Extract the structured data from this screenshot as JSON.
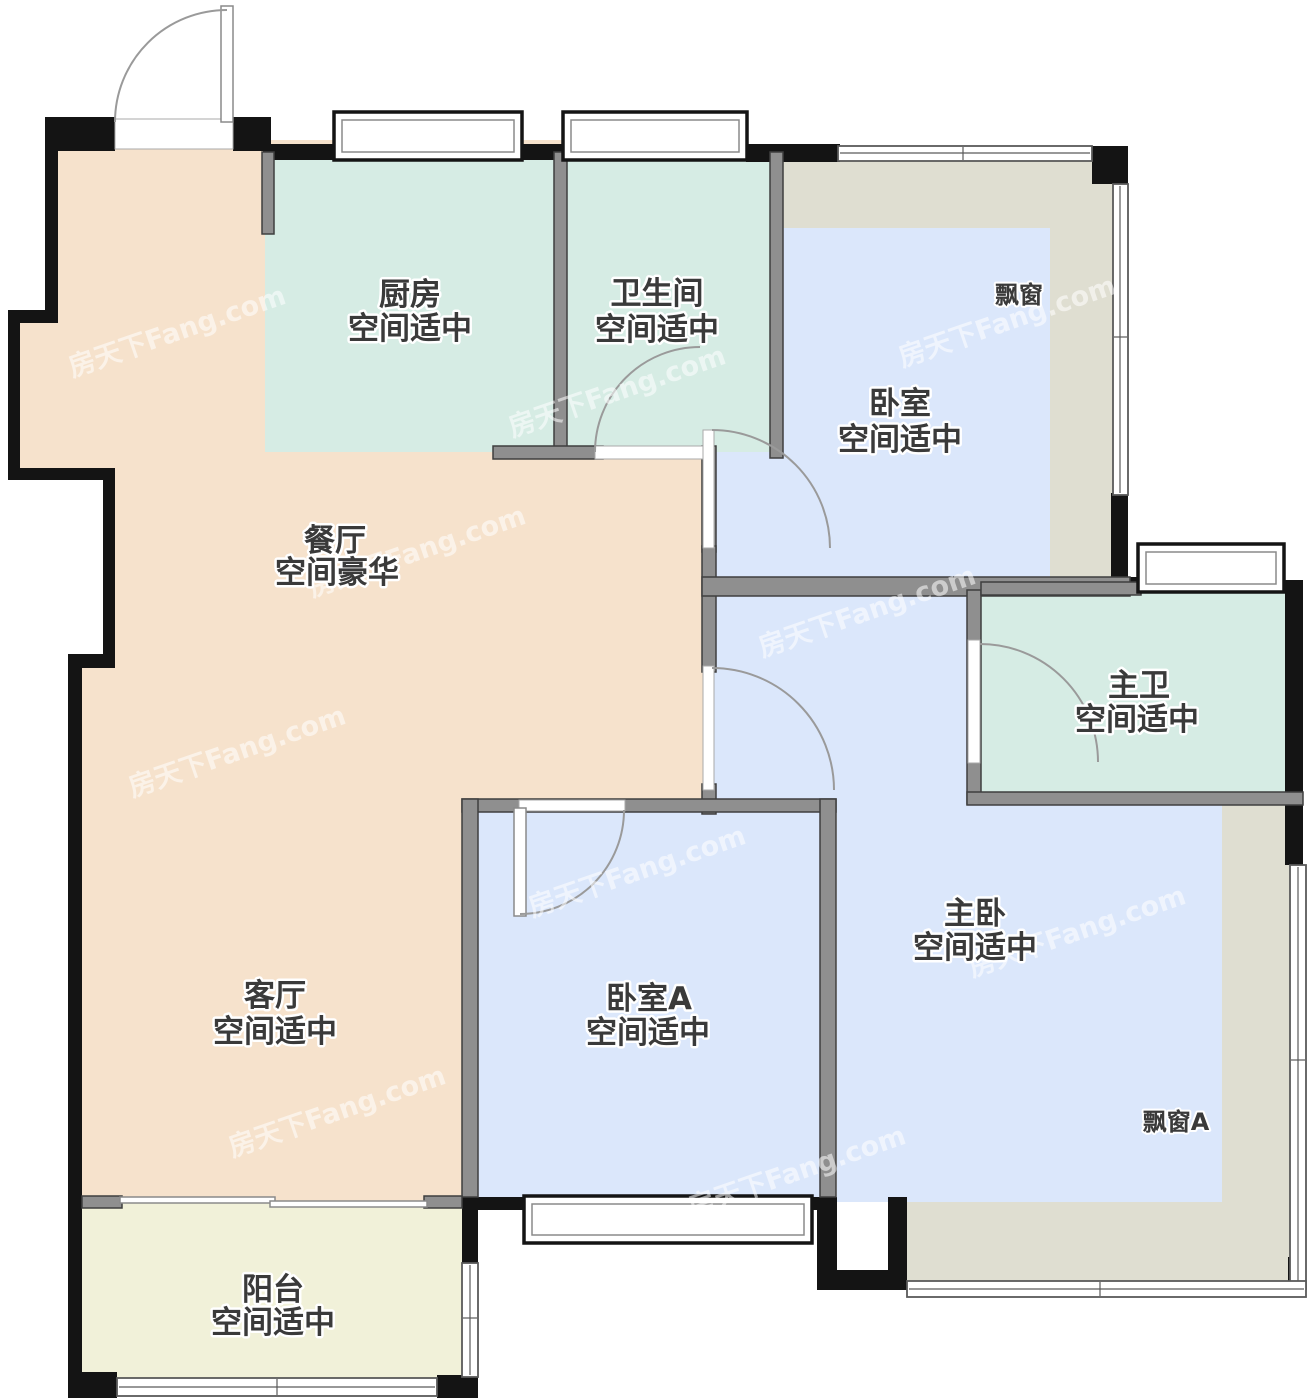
{
  "watermark": "房天下Fang.com",
  "rooms": {
    "kitchen": {
      "name": "厨房",
      "desc": "空间适中"
    },
    "bathroom": {
      "name": "卫生间",
      "desc": "空间适中"
    },
    "bedroom": {
      "name": "卧室",
      "desc": "空间适中"
    },
    "dining": {
      "name": "餐厅",
      "desc": "空间豪华"
    },
    "master_bath": {
      "name": "主卫",
      "desc": "空间适中"
    },
    "living": {
      "name": "客厅",
      "desc": "空间适中"
    },
    "bedroom_a": {
      "name": "卧室A",
      "desc": "空间适中"
    },
    "master_bedroom": {
      "name": "主卧",
      "desc": "空间适中"
    },
    "balcony": {
      "name": "阳台",
      "desc": "空间适中"
    }
  },
  "annotations": {
    "bay_window": "飘窗",
    "bay_window_a": "飘窗A"
  },
  "colors": {
    "dining_living": "#f6e2cc",
    "kitchen_bath": "#d6ece4",
    "bedroom_blue": "#dbe7fb",
    "bay_window": "#dfded1",
    "balcony": "#f1f1d9",
    "wall_black": "#141414",
    "wall_gray": "#8f8f8f",
    "label_text": "#3a3a3a"
  }
}
